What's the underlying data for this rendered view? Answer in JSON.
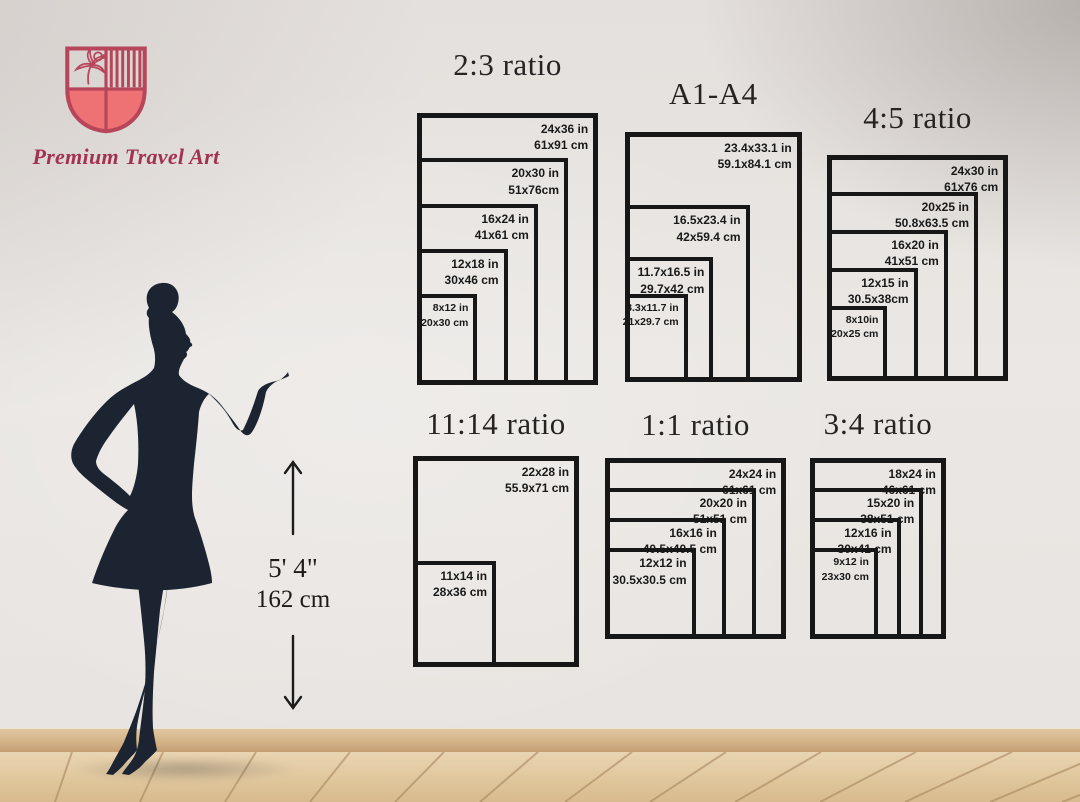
{
  "brand": {
    "name": "Premium Travel Art",
    "logo_icon": "crest-shield-icon",
    "crest_outline_color": "#b8465a",
    "crest_fill_color": "#ee7173",
    "brand_text_color": "#a13350"
  },
  "model": {
    "figure": "woman-silhouette",
    "height_imperial": "5' 4\"",
    "height_metric": "162 cm",
    "silhouette_color": "#1b2430"
  },
  "charts": [
    {
      "title": "2:3 ratio",
      "sizes": [
        {
          "in": "24x36 in",
          "cm": "61x91 cm",
          "w": 24,
          "h": 36
        },
        {
          "in": "20x30 in",
          "cm": "51x76cm",
          "w": 20,
          "h": 30
        },
        {
          "in": "16x24 in",
          "cm": "41x61 cm",
          "w": 16,
          "h": 24
        },
        {
          "in": "12x18 in",
          "cm": "30x46 cm",
          "w": 12,
          "h": 18
        },
        {
          "in": "8x12 in",
          "cm": "20x30 cm",
          "w": 8,
          "h": 12
        }
      ]
    },
    {
      "title": "A1-A4",
      "sizes": [
        {
          "in": "23.4x33.1 in",
          "cm": "59.1x84.1 cm",
          "w": 23.4,
          "h": 33.1
        },
        {
          "in": "16.5x23.4 in",
          "cm": "42x59.4 cm",
          "w": 16.5,
          "h": 23.4
        },
        {
          "in": "11.7x16.5 in",
          "cm": "29.7x42 cm",
          "w": 11.7,
          "h": 16.5
        },
        {
          "in": "8.3x11.7 in",
          "cm": "21x29.7 cm",
          "w": 8.3,
          "h": 11.7
        }
      ]
    },
    {
      "title": "4:5 ratio",
      "sizes": [
        {
          "in": "24x30 in",
          "cm": "61x76 cm",
          "w": 24,
          "h": 30
        },
        {
          "in": "20x25 in",
          "cm": "50.8x63.5 cm",
          "w": 20,
          "h": 25
        },
        {
          "in": "16x20 in",
          "cm": "41x51 cm",
          "w": 16,
          "h": 20
        },
        {
          "in": "12x15 in",
          "cm": "30.5x38cm",
          "w": 12,
          "h": 15
        },
        {
          "in": "8x10in",
          "cm": "20x25 cm",
          "w": 8,
          "h": 10
        }
      ]
    },
    {
      "title": "11:14 ratio",
      "sizes": [
        {
          "in": "22x28 in",
          "cm": "55.9x71 cm",
          "w": 22,
          "h": 28
        },
        {
          "in": "11x14 in",
          "cm": "28x36 cm",
          "w": 11,
          "h": 14
        }
      ]
    },
    {
      "title": "1:1 ratio",
      "sizes": [
        {
          "in": "24x24 in",
          "cm": "61x61 cm",
          "w": 24,
          "h": 24
        },
        {
          "in": "20x20 in",
          "cm": "51x51 cm",
          "w": 20,
          "h": 20
        },
        {
          "in": "16x16 in",
          "cm": "40.5x40.5 cm",
          "w": 16,
          "h": 16
        },
        {
          "in": "12x12 in",
          "cm": "30.5x30.5 cm",
          "w": 12,
          "h": 12
        }
      ]
    },
    {
      "title": "3:4 ratio",
      "sizes": [
        {
          "in": "18x24 in",
          "cm": "46x61 cm",
          "w": 18,
          "h": 24
        },
        {
          "in": "15x20 in",
          "cm": "38x51 cm",
          "w": 15,
          "h": 20
        },
        {
          "in": "12x16 in",
          "cm": "30x41 cm",
          "w": 12,
          "h": 16
        },
        {
          "in": "9x12 in",
          "cm": "23x30 cm",
          "w": 9,
          "h": 12
        }
      ]
    }
  ],
  "colors": {
    "wall": "#e9e6e3",
    "chart_line": "#171717",
    "floor": "#e2c9a0",
    "baseboard": "#d5b488"
  }
}
